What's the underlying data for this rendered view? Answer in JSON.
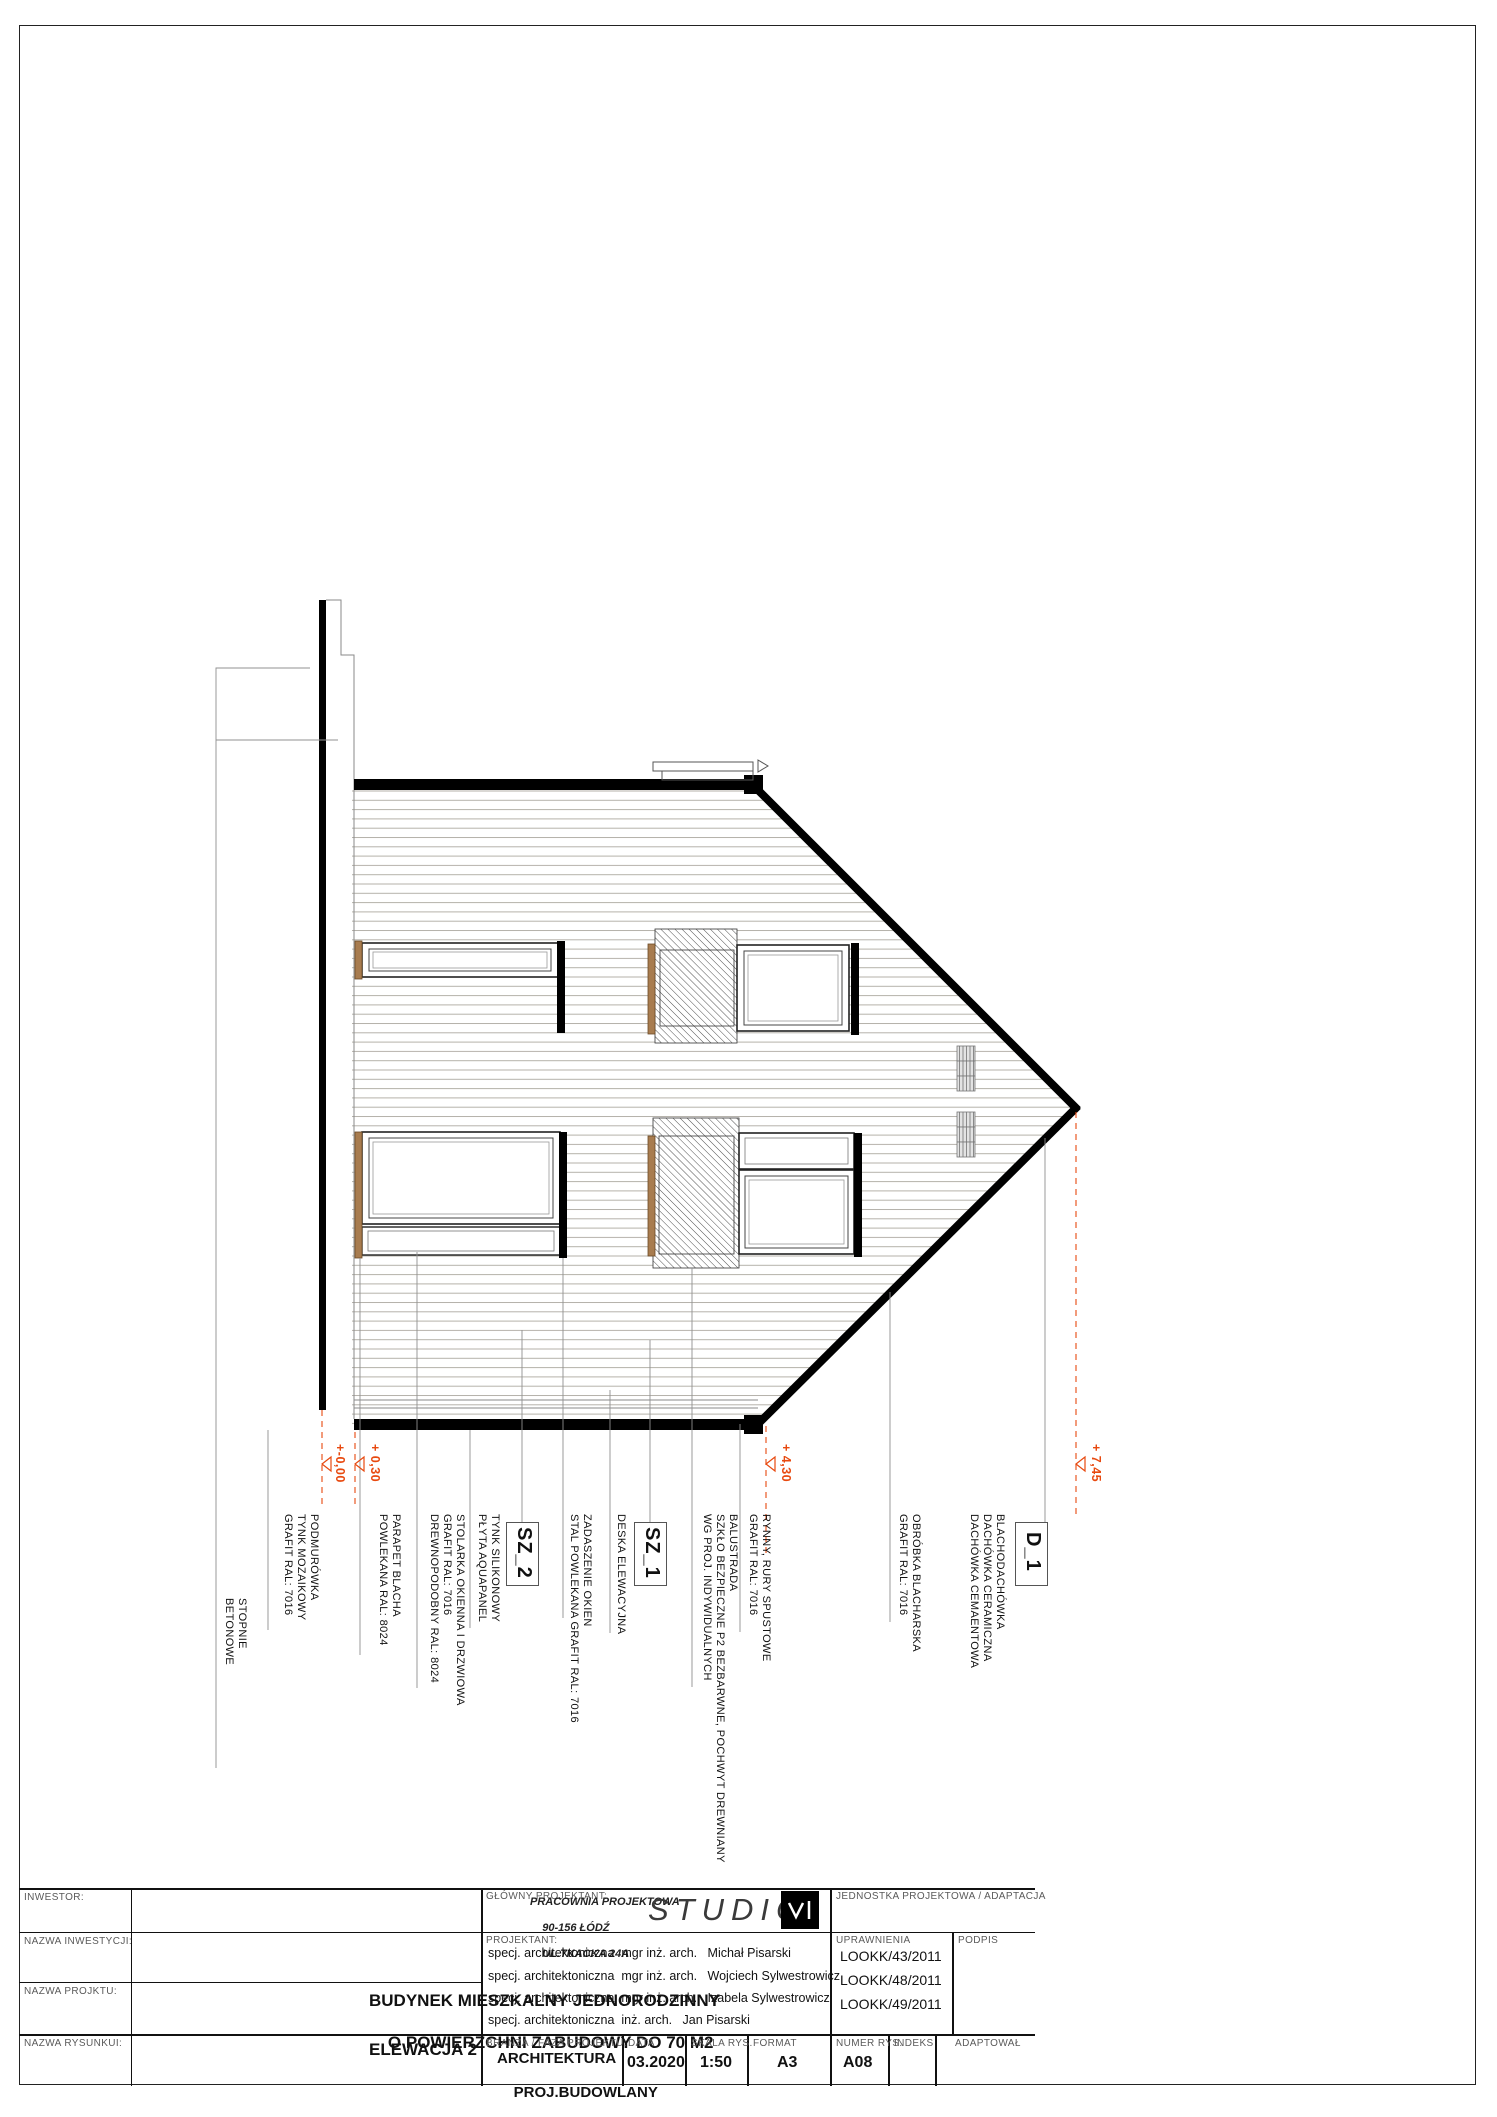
{
  "drawing": {
    "labels": {
      "stopnie": "STOPNIE\nBETONOWE",
      "podmurowka": "PODMURÓWKA\nTYNK MOZAIKOWY\nGRAFIT RAL: 7016",
      "parapet": "PARAPET BLACHA\nPOWLEKANA RAL: 8024",
      "stolarka": "STOLARKA OKIENNA I DRZWIOWA\nGRAFIT RAL: 7016\nDREWNOPODOBNY RAL: 8024",
      "tynk": "TYNK SILIKONOWY\nPŁYTA AQUAPANEL",
      "zadaszenie": "ZADASZENIE OKIEN\nSTAL POWLEKANA GRAFIT RAL: 7016",
      "deska": "DESKA ELEWACYJNA",
      "balustrada": "BALUSTRADA\nSZKŁO BEZPIECZNE P2 BEZBARWNE, POCHWYT DREWNIANY\nWG PROJ. INDYWIDUALNYCH",
      "rynny": "RYNNY, RURY SPUSTOWE\nGRAFIT RAL: 7016",
      "obrobka": "OBRÓBKA BLACHARSKA\nGRAFIT RAL: 7016",
      "blachodachowka": "BLACHODACHÓWKA\nDACHÓWKA CERAMICZNA\nDACHÓWKA CEMAENTOWA"
    },
    "section_marks": {
      "sz2": "SZ_2",
      "sz1": "SZ_1",
      "d1": "D_1"
    },
    "level_markers": {
      "m000": "+-0,00",
      "m030": "+ 0,30",
      "m430": "+ 4,30",
      "m745": "+ 7,45"
    },
    "colors": {
      "accent_orange": "#e8490f",
      "wood_brown": "#a87c4f",
      "siding_line": "#b5b2aa"
    }
  },
  "title_block": {
    "inwestor_label": "INWESTOR:",
    "nazwa_inwestycji_label": "NAZWA INWESTYCJI:",
    "nazwa_projektu_label": "NAZWA PROJKTU:",
    "nazwa_rysunku_label": "NAZWA RYSUNKUI:",
    "project_name_line1": "BUDYNEK MIESZKALNY JEDNORODZINNY",
    "project_name_line2": "O POWIERZCHNI ZABUDOWY DO 70 M2",
    "drawing_name": "ELEWACJA 2",
    "glowny_projektant_label": "GŁÓWNY PROJEKTANT:",
    "studio_address_line1": "PRACOWNIA PROJEKTOWA",
    "studio_address_line2": "90-156 ŁÓDŹ",
    "studio_address_line3": "UL.TKACKA 24A",
    "studio_logo_text": "STUDIO",
    "jednostka_label": "JEDNOSTKA PROJEKTOWA / ADAPTACJA",
    "projektant_label": "PROJEKTANT:",
    "projektant_rows": [
      "specj. architektoniczna  mgr inż. arch.   Michał Pisarski",
      "specj. architektoniczna  mgr inż. arch.   Wojciech Sylwestrowicz",
      "specj. architektoniczna  mgr inż. arch.   Izabela Sylwestrowicz",
      "specj. architektoniczna  inż. arch.   Jan Pisarski"
    ],
    "uprawnienia_label": "UPRAWNIENIA",
    "uprawnienia_rows": [
      "LOOKK/43/2011",
      "LOOKK/48/2011",
      "LOOKK/49/2011"
    ],
    "podpis_label": "PODPIS",
    "branza_label": "BRANŻA / FAZA PROJEKTU:",
    "branza_value_line1": "ARCHITEKTURA",
    "branza_value_line2": "PROJ.BUDOWLANY",
    "data_label": "DATA",
    "data_value": "03.2020",
    "skala_label": "SKALA RYS.",
    "skala_value": "1:50",
    "format_label": "FORMAT",
    "format_value": "A3",
    "numer_label": "NUMER RYS.",
    "numer_value": "A08",
    "indeks_label": "INDEKS",
    "adaptowal_label": "ADAPTOWAŁ"
  }
}
